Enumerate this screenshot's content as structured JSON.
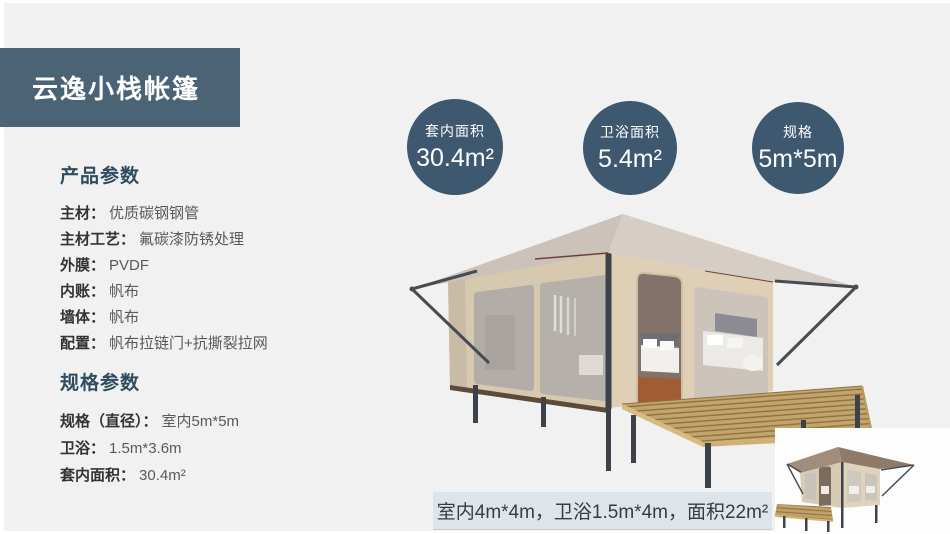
{
  "title": "云逸小栈帐篷",
  "sections": {
    "product": {
      "heading": "产品参数",
      "items": [
        {
          "label": "主材：",
          "value": "优质碳钢钢管"
        },
        {
          "label": "主材工艺：",
          "value": "氟碳漆防锈处理"
        },
        {
          "label": "外膜：",
          "value": "PVDF"
        },
        {
          "label": "内账：",
          "value": "帆布"
        },
        {
          "label": "墙体：",
          "value": "帆布"
        },
        {
          "label": "配置：",
          "value": "帆布拉链门+抗撕裂拉网"
        }
      ]
    },
    "spec": {
      "heading": "规格参数",
      "items": [
        {
          "label": "规格（直径）：",
          "value": "室内5m*5m"
        },
        {
          "label": "卫浴：",
          "value": "1.5m*3.6m"
        },
        {
          "label": "套内面积：",
          "value": "30.4m²"
        }
      ]
    }
  },
  "stat_circles": [
    {
      "label": "套内面积",
      "value": "30.4m²"
    },
    {
      "label": "卫浴面积",
      "value": "5.4m²"
    },
    {
      "label": "规格",
      "value": "5m*5m"
    }
  ],
  "caption": "室内4m*4m，卫浴1.5m*4m，面积22m²",
  "colors": {
    "accent_block": "#4a6375",
    "stat_circle": "#3e5870",
    "heading": "#2f4d5f",
    "caption_bg": "#dde5eb",
    "page_bg": "#f1f1f2",
    "tent_roof": "#d6cdc5",
    "tent_wall": "#d7c9b0",
    "deck_wood": "#c3a46b"
  }
}
